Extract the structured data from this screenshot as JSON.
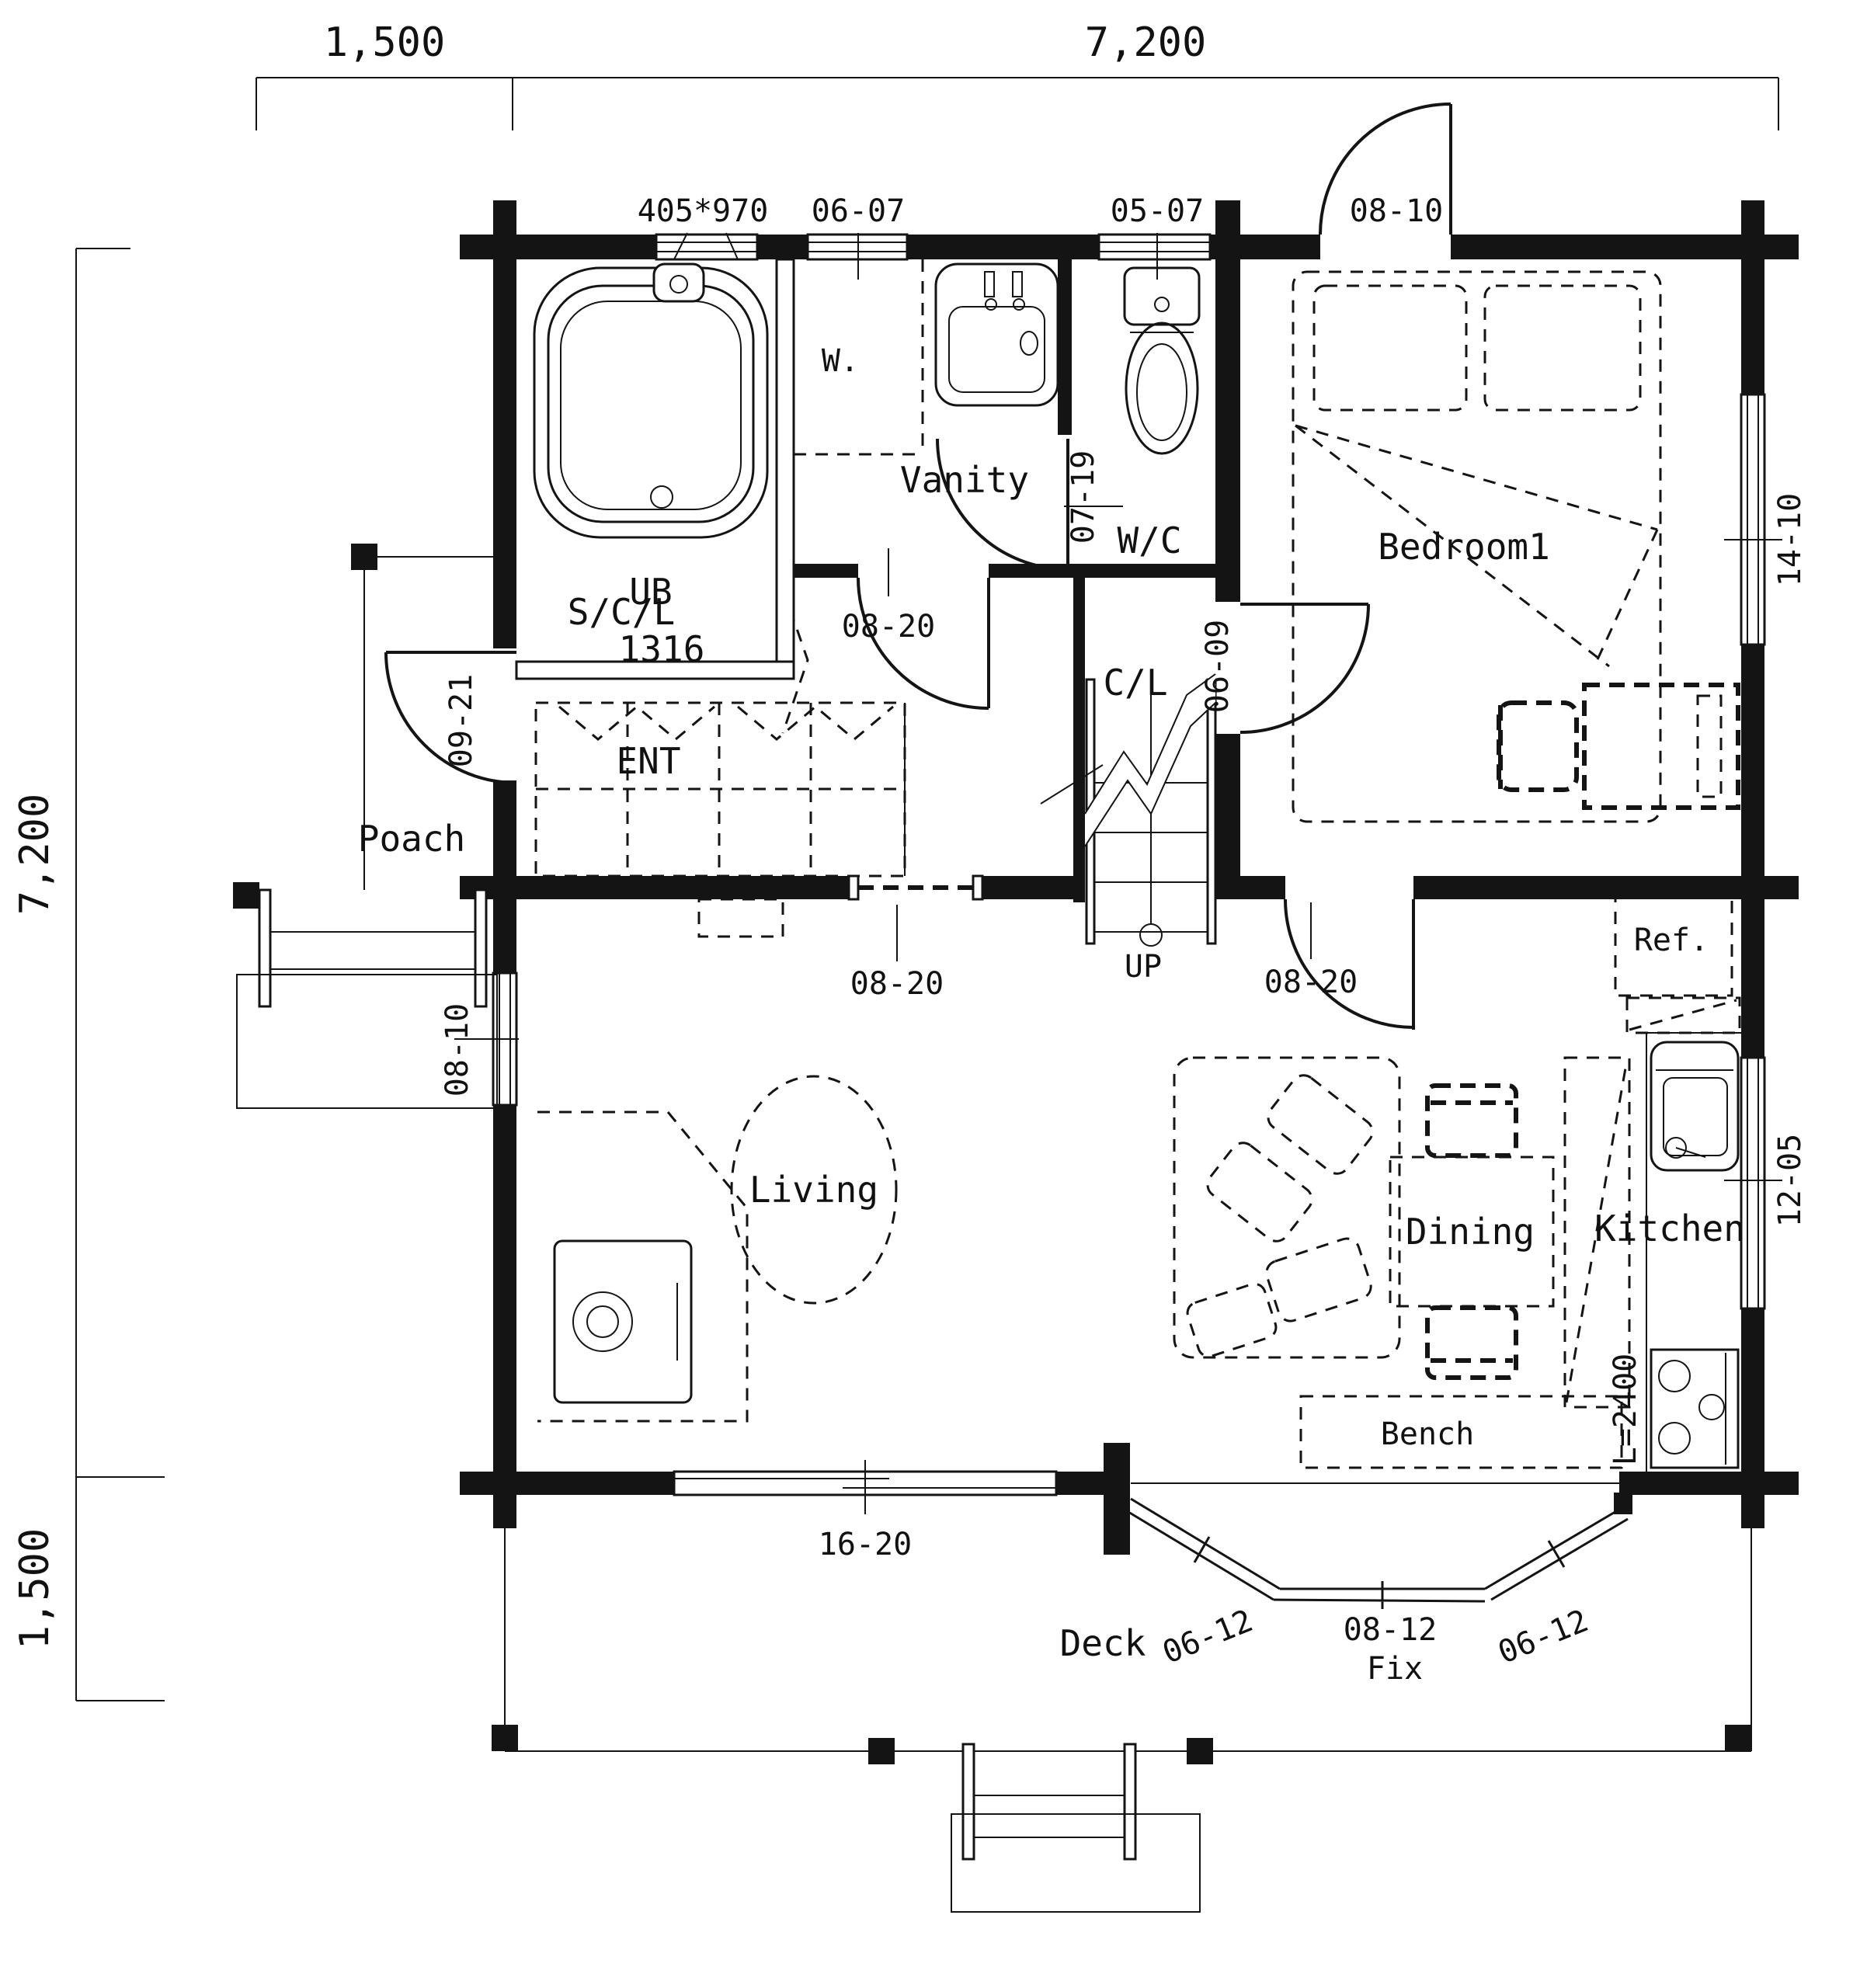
{
  "dimensions": {
    "top_left": "1,500",
    "top_right": "7,200",
    "left_top": "7,200",
    "left_bottom": "1,500"
  },
  "rooms": {
    "ub_line1": "UB",
    "ub_line2": "1316",
    "washer": "W.",
    "vanity": "Vanity",
    "wc": "W/C",
    "scl": "S/C/L",
    "ent": "ENT",
    "cl": "C/L",
    "poach": "Poach",
    "bedroom": "Bedroom1",
    "living": "Living",
    "dining": "Dining",
    "kitchen": "Kitchen",
    "deck": "Deck",
    "bench": "Bench",
    "ref": "Ref."
  },
  "openings": {
    "bath_window": "405*970",
    "win_0607": "06-07",
    "win_0507": "05-07",
    "door_0810_top": "08-10",
    "door_0719": "07-19",
    "door_0820_upper": "08-20",
    "door_0921": "09-21",
    "door_0609": "06-09",
    "door_0820_left": "08-20",
    "door_0820_right": "08-20",
    "win_0810_left": "08-10",
    "win_1410": "14-10",
    "win_1205": "12-05",
    "win_1620": "16-20",
    "win_0612_left": "06-12",
    "win_0812": "08-12",
    "win_fix": "Fix",
    "win_0612_right": "06-12",
    "counter_len": "L=2400"
  },
  "stairs": {
    "up": "UP"
  }
}
